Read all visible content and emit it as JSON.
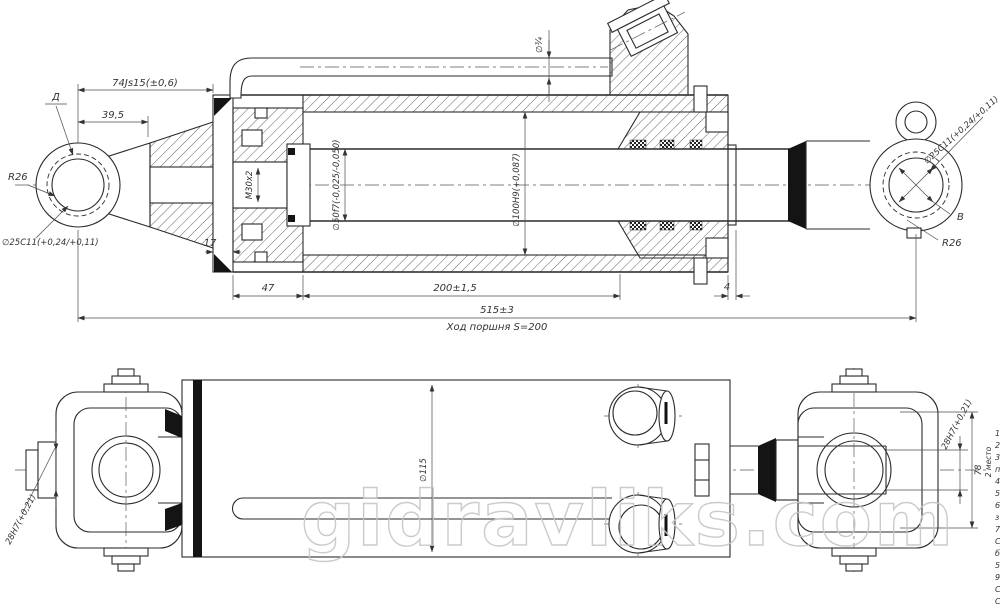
{
  "watermark": "gidravliks.com",
  "top_view": {
    "labels": {
      "flag_d": "Д",
      "dim_74": "74Js15(±0,6)",
      "dim_39_5": "39,5",
      "r26_left": "R26",
      "hole_left": "∅25C11(+0,24/+0,11)",
      "thread": "M30x2",
      "dim_17": "17",
      "rod_dia": "∅50f7(-0,025/-0,050)",
      "bore_dia": "∅100H9(+0,087)",
      "tube_dia": "∅¾",
      "dim_47": "47",
      "dim_200": "200±1,5",
      "dim_4": "4",
      "dim_515": "515±3",
      "stroke_note": "Ход поршня S=200",
      "flag_b": "В",
      "r26_right": "R26",
      "hole_right": "∅25C11(+0,24/+0,11)"
    }
  },
  "bottom_view": {
    "labels": {
      "pin_left": "28H7(+0,21)",
      "barrel_dia": "∅115",
      "pin_right": "28H7(+0,21)",
      "dim_78": "78",
      "places_note": "2 место",
      "edge_numbers": [
        "1",
        "2",
        "3",
        "п",
        "4",
        "5",
        "6",
        "з",
        "7",
        "С",
        "б",
        "5",
        "9",
        "С",
        "С"
      ]
    }
  }
}
